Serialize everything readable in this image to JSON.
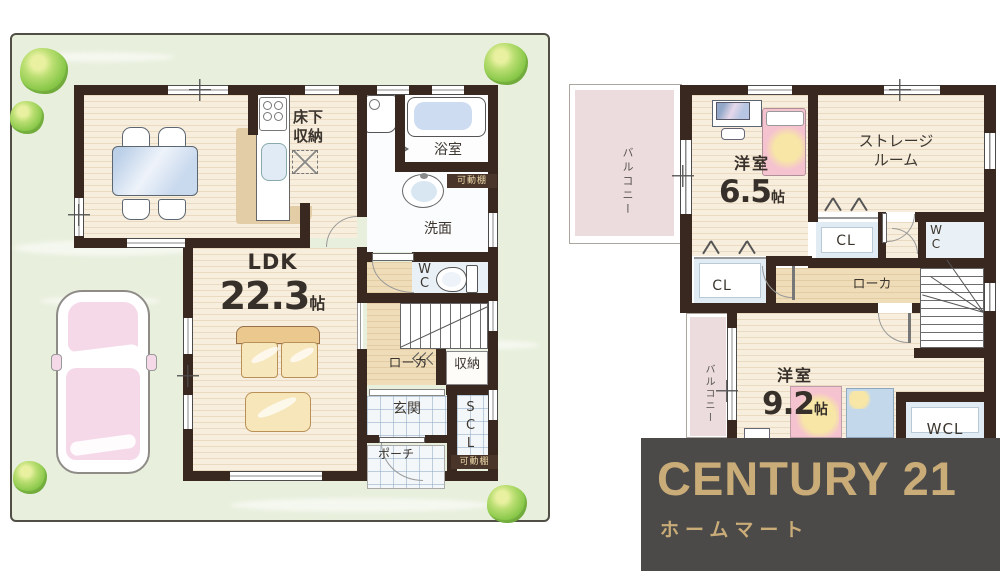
{
  "brand": {
    "name": "CENTURY 21",
    "subtitle": "ホームマート",
    "banner_bg": "#4b4a48",
    "gold": "#c9ac78"
  },
  "palette": {
    "wall": "#38281f",
    "site_green": "#e8efdc",
    "wood_floor": "#f8eedd",
    "hall_floor": "#efddb9",
    "tile_blue": "#f3f7fa",
    "balcony_pink": "#ecdcdd"
  },
  "floor1": {
    "ldk_name": "LDK",
    "ldk_size": "22.3",
    "ldk_unit": "帖",
    "underfloor_storage": "床下収納",
    "bath": "浴室",
    "movable_shelf_top": "可動棚",
    "washroom": "洗面",
    "wc": "WC",
    "hallway": "ローカ",
    "storage": "収納",
    "entrance": "玄関",
    "shoe_closet": "SCL",
    "porch": "ポーチ",
    "movable_shelf_bottom": "可動棚"
  },
  "floor2": {
    "balcony_top": "バルコニー",
    "bedroom1_name": "洋室",
    "bedroom1_size": "6.5",
    "bedroom1_unit": "帖",
    "storage_room": "ストレージルーム",
    "closet_left": "CL",
    "closet_right": "CL",
    "wc": "WC",
    "hallway": "ローカ",
    "bedroom2_name": "洋室",
    "bedroom2_size": "9.2",
    "bedroom2_unit": "帖",
    "walkin_closet": "WCL",
    "balcony_bottom": "バルコニー"
  }
}
